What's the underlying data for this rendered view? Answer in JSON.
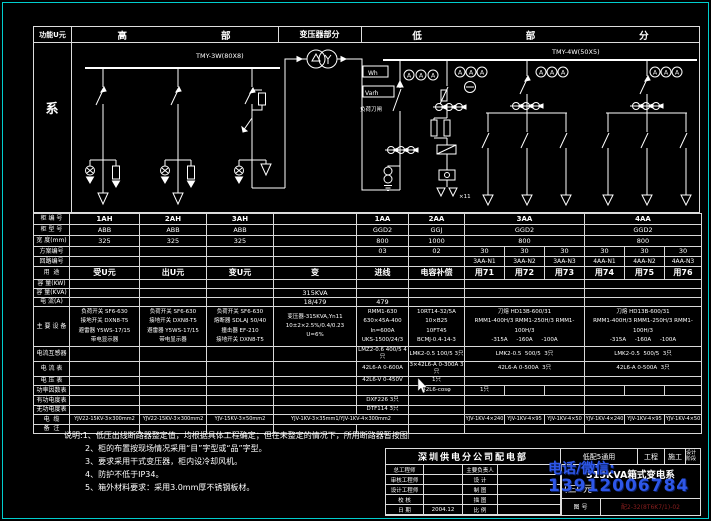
{
  "colors": {
    "frame": "#00cdcd",
    "lines": "#ffffff",
    "watermark": "#2e57e8",
    "doc_no_red": "#8b1f1f"
  },
  "header": {
    "function_col": "功能U元",
    "function_body": "系",
    "hv_section_chars": [
      "高",
      "部"
    ],
    "transformer_section": "变压器部分",
    "lv_section_chars": [
      "低",
      "部",
      "分"
    ]
  },
  "schematic": {
    "hv_bus_label": "TMY-3W(80X8)",
    "lv_bus_label": "TMY-4W(50X5)",
    "wh_meter": "Wh",
    "varh_meter": "Varh",
    "ammeter_letter": "A",
    "knife_switch_label": "负荷刀闸",
    "capacitor_count": "×11"
  },
  "table": {
    "row_labels": [
      "柜 编 号",
      "柜 型 号",
      "宽 度(mm)",
      "方案编号",
      "回路编号",
      "用  途",
      "容 量(KW)",
      "容 量(KVA)",
      "电 流(A)",
      "主 要 设 备",
      "电流互感器",
      "电 流 表",
      "电 压 表",
      "功率因数表",
      "有功电度表",
      "无功电度表",
      "电  缆",
      "备  注"
    ],
    "rows": [
      [
        [
          1,
          "1AH"
        ],
        [
          1,
          "2AH"
        ],
        [
          1,
          "3AH"
        ],
        [
          1,
          ""
        ],
        [
          1,
          "1AA"
        ],
        [
          1,
          "2AA"
        ],
        [
          3,
          "3AA"
        ],
        [
          3,
          "4AA"
        ]
      ],
      [
        [
          1,
          "ABB"
        ],
        [
          1,
          "ABB"
        ],
        [
          1,
          "ABB"
        ],
        [
          1,
          ""
        ],
        [
          1,
          "GGD2"
        ],
        [
          1,
          "GGJ"
        ],
        [
          3,
          "GGD2"
        ],
        [
          3,
          "GGD2"
        ]
      ],
      [
        [
          1,
          "325"
        ],
        [
          1,
          "325"
        ],
        [
          1,
          "325"
        ],
        [
          1,
          ""
        ],
        [
          1,
          "800"
        ],
        [
          1,
          "1000"
        ],
        [
          3,
          "800"
        ],
        [
          3,
          "800"
        ]
      ],
      [
        [
          1,
          ""
        ],
        [
          1,
          ""
        ],
        [
          1,
          ""
        ],
        [
          1,
          ""
        ],
        [
          1,
          "03"
        ],
        [
          1,
          "02"
        ],
        [
          1,
          "30"
        ],
        [
          1,
          "30"
        ],
        [
          1,
          "30"
        ],
        [
          1,
          "30"
        ],
        [
          1,
          "30"
        ],
        [
          1,
          "30"
        ]
      ],
      [
        [
          1,
          ""
        ],
        [
          1,
          ""
        ],
        [
          1,
          ""
        ],
        [
          1,
          ""
        ],
        [
          1,
          ""
        ],
        [
          1,
          ""
        ],
        [
          1,
          "3AA-N1"
        ],
        [
          1,
          "3AA-N2"
        ],
        [
          1,
          "3AA-N3"
        ],
        [
          1,
          "4AA-N1"
        ],
        [
          1,
          "4AA-N2"
        ],
        [
          1,
          "4AA-N3"
        ]
      ],
      [
        [
          1,
          "受U元"
        ],
        [
          1,
          "出U元"
        ],
        [
          1,
          "变U元"
        ],
        [
          1,
          "变"
        ],
        [
          1,
          "进线"
        ],
        [
          1,
          "电容补偿"
        ],
        [
          1,
          "用71"
        ],
        [
          1,
          "用72"
        ],
        [
          1,
          "用73"
        ],
        [
          1,
          "用74"
        ],
        [
          1,
          "用75"
        ],
        [
          1,
          "用76"
        ]
      ],
      [
        [
          1,
          ""
        ],
        [
          1,
          ""
        ],
        [
          1,
          ""
        ],
        [
          1,
          ""
        ],
        [
          1,
          ""
        ],
        [
          1,
          ""
        ],
        [
          3,
          ""
        ],
        [
          3,
          ""
        ]
      ],
      [
        [
          1,
          ""
        ],
        [
          1,
          ""
        ],
        [
          1,
          ""
        ],
        [
          1,
          "315KVA"
        ],
        [
          1,
          ""
        ],
        [
          1,
          ""
        ],
        [
          3,
          ""
        ],
        [
          3,
          ""
        ]
      ],
      [
        [
          1,
          ""
        ],
        [
          1,
          ""
        ],
        [
          1,
          ""
        ],
        [
          1,
          "18/479"
        ],
        [
          1,
          "479"
        ],
        [
          1,
          ""
        ],
        [
          3,
          ""
        ],
        [
          3,
          ""
        ]
      ],
      [
        [
          1,
          "负荷开关 SF6-630\n接地开关 DXN8-T5\n避雷器 Y5WS-17/15\n带电显示器"
        ],
        [
          1,
          "负荷开关 SF6-630\n接地开关 DXN8-T5\n避雷器 Y5WS-17/15\n带电显示器"
        ],
        [
          1,
          "负荷开关 SF6-630\n熔断器 SDLAJ 50/40\n撞击器 EF-210\n接地开关 DXN8-T5"
        ],
        [
          1,
          "变压器-315KVA,Yn11\n10±2×2.5%/0.4/0.23\nU=6%"
        ],
        [
          1,
          "RMM1-630 630×45A-400\nIn=600A\nUKS-1500/24/3"
        ],
        [
          1,
          "10RT14-32/5A\n10×B25\n10FT45\nBCMJ-0.4-14-3"
        ],
        [
          3,
          "刀熔 HD13B-600/31\nRMM1-400H/3 RMM1-250H/3 RMM1-100H/3\n-315A     -160A     -100A"
        ],
        [
          3,
          "刀熔 HD13B-600/31\nRMM1-400H/3 RMM1-250H/3 RMM1-100H/3\n-315A     -160A     -100A"
        ]
      ],
      [
        [
          1,
          ""
        ],
        [
          1,
          ""
        ],
        [
          1,
          ""
        ],
        [
          1,
          ""
        ],
        [
          1,
          "LMZ2-0.6 400/5 4只"
        ],
        [
          1,
          "LMK2-0.5 100/5 3只"
        ],
        [
          3,
          "LMK2-0.5  500/5  3只"
        ],
        [
          3,
          "LMK2-0.5  500/5  3只"
        ]
      ],
      [
        [
          1,
          ""
        ],
        [
          1,
          ""
        ],
        [
          1,
          ""
        ],
        [
          1,
          ""
        ],
        [
          1,
          "42L6-A 0-600A"
        ],
        [
          1,
          "3×42L6-A 0-300A 3只"
        ],
        [
          3,
          "42L6-A 0-500A  3只"
        ],
        [
          3,
          "42L6-A 0-500A  3只"
        ]
      ],
      [
        [
          1,
          ""
        ],
        [
          1,
          ""
        ],
        [
          1,
          ""
        ],
        [
          1,
          ""
        ],
        [
          1,
          "42L6-V 0-450V"
        ],
        [
          1,
          "1只"
        ],
        [
          3,
          ""
        ],
        [
          3,
          ""
        ]
      ],
      [
        [
          1,
          ""
        ],
        [
          1,
          ""
        ],
        [
          1,
          ""
        ],
        [
          1,
          ""
        ],
        [
          1,
          ""
        ],
        [
          1,
          "42L6-cosφ"
        ],
        [
          1,
          "1只"
        ],
        [
          1,
          ""
        ],
        [
          1,
          ""
        ],
        [
          1,
          ""
        ],
        [
          1,
          ""
        ],
        [
          1,
          ""
        ]
      ],
      [
        [
          1,
          ""
        ],
        [
          1,
          ""
        ],
        [
          1,
          ""
        ],
        [
          1,
          ""
        ],
        [
          1,
          "DXF226 3只"
        ],
        [
          1,
          ""
        ],
        [
          3,
          ""
        ],
        [
          3,
          ""
        ]
      ],
      [
        [
          1,
          ""
        ],
        [
          1,
          ""
        ],
        [
          1,
          ""
        ],
        [
          1,
          ""
        ],
        [
          1,
          "DTF114 3只"
        ],
        [
          1,
          ""
        ],
        [
          3,
          ""
        ],
        [
          3,
          ""
        ]
      ],
      [
        [
          1,
          "YJV22-15KV-3×300mm2"
        ],
        [
          1,
          "YJV22-15KV-3×300mm2"
        ],
        [
          1,
          "YJV-15KV-3×50mm2"
        ],
        [
          2,
          "YJV-1KV-3×35mm1/YJV-1KV-4×300mm2"
        ],
        [
          1,
          ""
        ],
        [
          1,
          "YJV-1KV-4×240"
        ],
        [
          1,
          "YJV-1KV-4×95"
        ],
        [
          1,
          "YJV-1KV-4×50"
        ],
        [
          1,
          "YJV-1KV-4×240"
        ],
        [
          1,
          "YJV-1KV-4×95"
        ],
        [
          1,
          "YJV-1KV-4×50"
        ]
      ],
      [
        [
          1,
          ""
        ],
        [
          1,
          ""
        ],
        [
          1,
          ""
        ],
        [
          1,
          ""
        ],
        [
          1,
          ""
        ],
        [
          1,
          ""
        ],
        [
          3,
          ""
        ],
        [
          3,
          ""
        ]
      ]
    ]
  },
  "notes": {
    "lines": [
      "说明:1、低压出线断路器整定值，均根据具体工程确定；但在未整定的情况下，所用断路器暂按图配组整定。",
      "2、柜的布置按现场情况采用“目”字型或“品”字型。",
      "3、要求采用干式变压器，柜内设冷却风机。",
      "4、防护不低于IP34。",
      "5、箱外材料要求：采用3.0mm厚不锈钢板材。"
    ]
  },
  "title_block": {
    "company": "深圳供电分公司配电部",
    "doc_type": "低配5通用",
    "project": "工程",
    "construction": "施工",
    "stage": "设计阶段",
    "fields_left": [
      "总工程师",
      "审核工程师",
      "设计工程师",
      "校 核",
      "日 期"
    ],
    "date": "2004.12",
    "fields_mid": [
      "主要负责人",
      "设 计",
      "制 图",
      "描 图",
      "比 例"
    ],
    "title_line1": "315KVA箱式变电系",
    "title_line2": "(三U元",
    "doc_no_label": "图 号",
    "doc_no": "配2-32(8T6K7/1)-02"
  },
  "watermark": {
    "line1": "电话/微信:",
    "line2": "13912006784"
  }
}
